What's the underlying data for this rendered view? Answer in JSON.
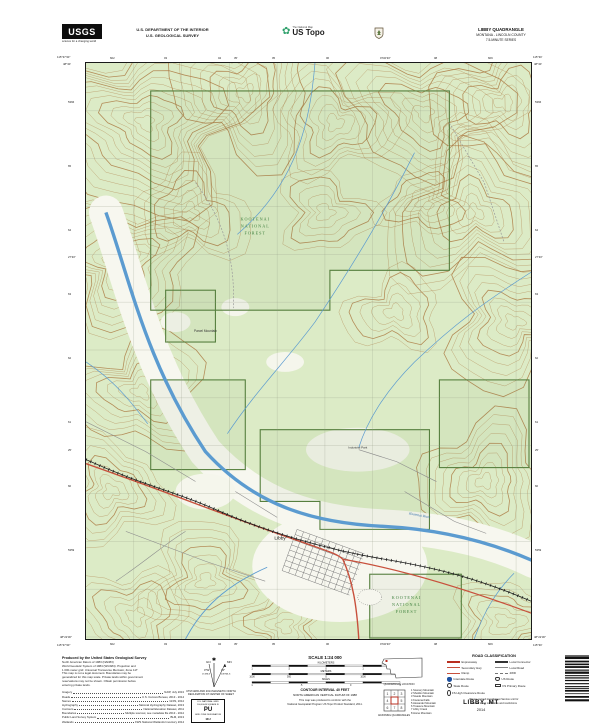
{
  "header": {
    "usgs": {
      "acronym": "USGS",
      "tagline": "science for a changing world"
    },
    "department_line1": "U.S. DEPARTMENT OF THE INTERIOR",
    "department_line2": "U.S. GEOLOGICAL SURVEY",
    "ustopo": {
      "brand": "The National Map",
      "product": "US Topo"
    },
    "quadrangle": {
      "title": "LIBBY QUADRANGLE",
      "region": "MONTANA - LINCOLN COUNTY",
      "series": "7.5-MINUTE SERIES"
    }
  },
  "map": {
    "labels": {
      "nf_upper_1": "KOOTENAI",
      "nf_upper_2": "NATIONAL",
      "nf_upper_3": "FOREST",
      "nf_lower_1": "KOOTENAI",
      "nf_lower_2": "NATIONAL",
      "nf_lower_3": "FOREST",
      "town": "Libby",
      "river": "Kootenai River",
      "mountain": "Parcel Mountain",
      "industrial_park": "Industrial Park"
    },
    "collar": {
      "top_left_lon": "115°37'30\"",
      "top_left_lat": "48°30'",
      "top_right_lon": "115°30'",
      "top_right_lat": "48°30'",
      "bottom_left_lon": "115°37'30\"",
      "bottom_left_lat": "48°22'30\"",
      "bottom_right_lon": "115°30'",
      "bottom_right_lat": "48°22'30\"",
      "top_ticks": [
        "602",
        "03",
        "04",
        "05",
        "06",
        "07",
        "08",
        "609"
      ],
      "bottom_ticks": [
        "602",
        "03",
        "04",
        "05",
        "06",
        "07",
        "08",
        "609"
      ],
      "left_ticks": [
        "5366",
        "65",
        "64",
        "63",
        "62",
        "61",
        "60",
        "5359"
      ],
      "right_ticks": [
        "5366",
        "65",
        "64",
        "63",
        "62",
        "61",
        "60",
        "5359"
      ],
      "top_mid_lons": [
        "35'",
        "32'30\""
      ],
      "side_mid_lats": [
        "27'30\"",
        "25'"
      ]
    }
  },
  "footer": {
    "produced_by": "Produced by the United States Geological Survey",
    "fine_print": [
      "North American Datum of 1983 (NAD83)",
      "World Geodetic System of 1984 (WGS84).  Projection and",
      "1 000-meter grid: Universal Transverse Mercator, Zone 11T",
      "This map is not a legal document. Boundaries may be",
      "generalized for this map scale. Private lands within government",
      "reservations may not be shown. Obtain permission before",
      "entering private lands."
    ],
    "sources": [
      {
        "name": "Imagery",
        "value": "NAIP, July 2013"
      },
      {
        "name": "Roads",
        "value": "U.S. Census Bureau, 2013 - 2014"
      },
      {
        "name": "Names",
        "value": "GNIS, 2014"
      },
      {
        "name": "Hydrography",
        "value": "National Hydrography Dataset, 2013"
      },
      {
        "name": "Contours",
        "value": "National Elevation Dataset, 2011"
      },
      {
        "name": "Boundaries",
        "value": "Multiple sources; see metadata file 2013 - 2014"
      },
      {
        "name": "Public Land Survey System",
        "value": "BLM, 2013"
      },
      {
        "name": "Wetlands",
        "value": "FWS National Wetlands Inventory 2014"
      }
    ],
    "declination": {
      "gn_label": "GN",
      "mn_label": "MN",
      "gn_angle": "0°52'",
      "gn_mils": "15 MILS",
      "mn_angle": "14°",
      "mn_mils": "249 MILS",
      "caption1": "UTM GRID AND 2014 MAGNETIC NORTH",
      "caption2": "DECLINATION AT CENTER OF SHEET"
    },
    "usng": {
      "title": "U.S. NATIONAL GRID",
      "subtitle": "100,000-M SQUARE ID",
      "square_id": "PU",
      "zone_label": "GRID ZONE DESIGNATION",
      "zone": "11U"
    },
    "scale": {
      "title": "SCALE 1:24 000",
      "bars": [
        {
          "unit": "KILOMETERS",
          "labels": [
            "1",
            ".5",
            "0",
            "1",
            "2"
          ]
        },
        {
          "unit": "METERS",
          "labels": [
            "1000",
            "500",
            "0",
            "1000",
            "2000"
          ]
        },
        {
          "unit": "MILES",
          "labels": [
            "1",
            ".5",
            "0",
            "1"
          ]
        }
      ],
      "feet": {
        "unit": "FEET",
        "labels": [
          "1000",
          "0",
          "1000",
          "2000",
          "3000",
          "4000",
          "5000",
          "6000",
          "7000",
          "8000",
          "9000",
          "10000"
        ]
      },
      "contour_line1": "CONTOUR INTERVAL 40 FEET",
      "contour_line2": "NORTH AMERICAN VERTICAL DATUM OF 1988",
      "standard_line1": "This map was produced to conform with the",
      "standard_line2": "National Geospatial Program US Topo Product Standard, 2011."
    },
    "location": {
      "caption": "QUADRANGLE LOCATION"
    },
    "adjoining": {
      "caption": "ADJOINING QUADRANGLES",
      "names": [
        "1  Scenery Mountain",
        "2  Sheldon Mountain",
        "3  Swede Mountain",
        "4  Kootenai Falls",
        "5  Alexander Mountain",
        "6  Treasure Mountain",
        "7  Libby Creek",
        "8  Horse Mountain"
      ]
    },
    "legend": {
      "title": "ROAD CLASSIFICATION",
      "expressway": "Expressway",
      "secondary": "Secondary Hwy",
      "ramp": "Ramp",
      "local_connector": "Local Connector",
      "local_road": "Local Road",
      "fourwd": "4WD",
      "interstate": "Interstate Route",
      "us_route": "US Route",
      "state_route": "State Route",
      "fs_primary": "FS Primary Route",
      "fs_high": "FS High Clearance Route",
      "note1": "Please consult local Forest Service unit for",
      "note2": "current travel conditions and restrictions"
    },
    "sheet": {
      "name": "LIBBY, MT",
      "year": "2014"
    }
  },
  "colors": {
    "woodland": "#dcebc6",
    "contour": "#ad7c45",
    "water": "#5b9bd0",
    "highway_red": "#c8503c",
    "forest_boundary": "#567f3e",
    "nf_label": "#3a7d3a"
  }
}
